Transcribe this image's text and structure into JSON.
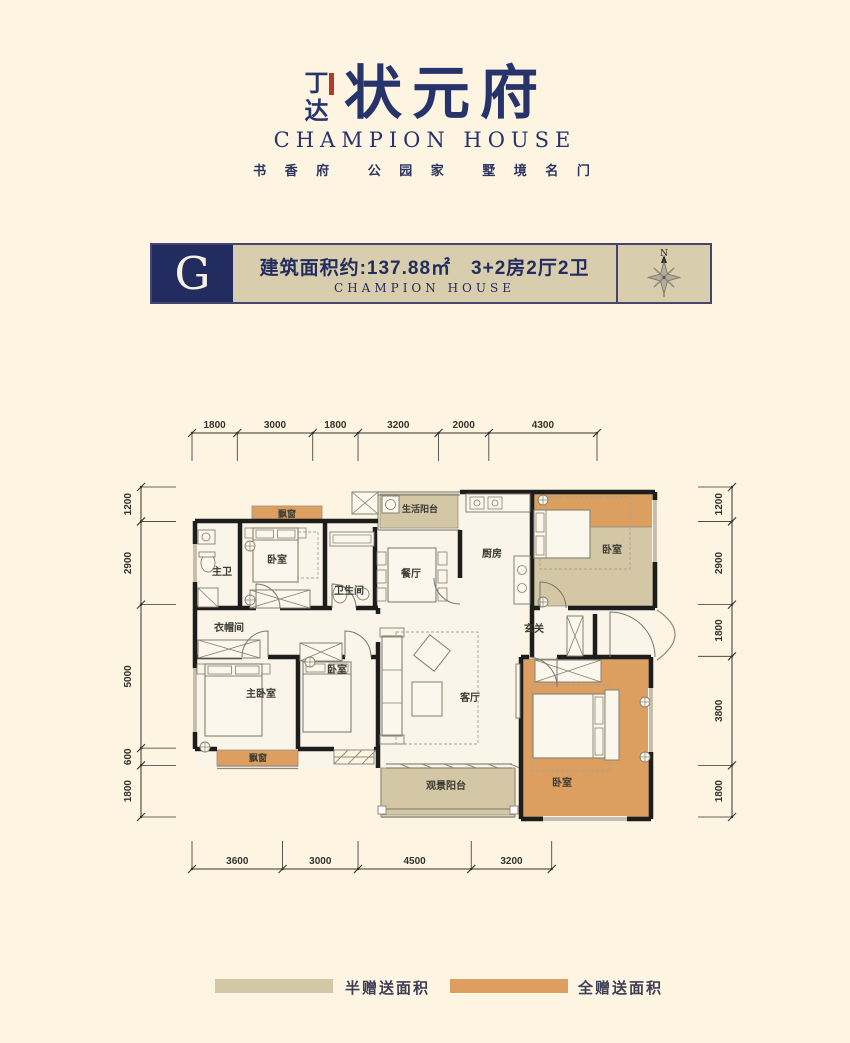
{
  "logo": {
    "brand_vertical": "丁达",
    "seal_color": "#b43a2a",
    "title": "状元府",
    "title_en": "CHAMPION HOUSE",
    "tagline": "书 香 府　 公 园 家　 墅 境 名 门",
    "color": "#27336b"
  },
  "banner": {
    "unit_letter": "G",
    "line1": "建筑面积约:137.88㎡　3+2房2厅2卫",
    "line2": "CHAMPION  HOUSE",
    "navy": "#232c5f",
    "beige": "#d8cdad",
    "border": "#45456d",
    "compass": {
      "label": "N"
    }
  },
  "floor_plan": {
    "wall_color": "#1d1d1d",
    "room_fill": "#faf5e8",
    "half_gift_color": "#d3c7a6",
    "full_gift_color": "#dc9f60",
    "dims": {
      "top": [
        1800,
        3000,
        1800,
        3200,
        2000,
        4300
      ],
      "bottom": [
        3600,
        3000,
        4500,
        3200
      ],
      "left": [
        1200,
        2900,
        5000,
        600,
        1800
      ],
      "right": [
        1200,
        2900,
        1800,
        3800,
        1800
      ]
    },
    "zones": [
      {
        "type": "full",
        "name": "bay-window-bedroom1",
        "x": 252,
        "y": 506,
        "w": 70,
        "h": 15
      },
      {
        "type": "full",
        "name": "bedroom2-upper",
        "x": 534,
        "y": 494,
        "w": 119,
        "h": 33
      },
      {
        "type": "half",
        "name": "bedroom2-lower",
        "x": 534,
        "y": 527,
        "w": 119,
        "h": 79
      },
      {
        "type": "half",
        "name": "life-balcony",
        "x": 380,
        "y": 494,
        "w": 78,
        "h": 34
      },
      {
        "type": "full",
        "name": "bay-window-master",
        "x": 217,
        "y": 750,
        "w": 81,
        "h": 16
      },
      {
        "type": "full",
        "name": "bedroom4",
        "x": 523,
        "y": 659,
        "w": 126,
        "h": 158
      },
      {
        "type": "half",
        "name": "view-balcony",
        "x": 381,
        "y": 768,
        "w": 134,
        "h": 47
      }
    ],
    "labels": [
      {
        "text": "主卫",
        "x": 222,
        "y": 575
      },
      {
        "text": "卧室",
        "x": 277,
        "y": 563
      },
      {
        "text": "卫生间",
        "x": 349,
        "y": 594
      },
      {
        "text": "餐厅",
        "x": 411,
        "y": 577
      },
      {
        "text": "生活阳台",
        "x": 420,
        "y": 512,
        "s": 9
      },
      {
        "text": "厨房",
        "x": 492,
        "y": 557
      },
      {
        "text": "卧室",
        "x": 612,
        "y": 553
      },
      {
        "text": "玄关",
        "x": 534,
        "y": 632
      },
      {
        "text": "衣帽间",
        "x": 229,
        "y": 631
      },
      {
        "text": "主卧室",
        "x": 261,
        "y": 697
      },
      {
        "text": "卧室",
        "x": 337,
        "y": 673
      },
      {
        "text": "客厅",
        "x": 470,
        "y": 701
      },
      {
        "text": "飘窗",
        "x": 287,
        "y": 517,
        "s": 9
      },
      {
        "text": "飘窗",
        "x": 258,
        "y": 761,
        "s": 9
      },
      {
        "text": "观景阳台",
        "x": 446,
        "y": 789
      },
      {
        "text": "卧室",
        "x": 562,
        "y": 786
      }
    ]
  },
  "legend": [
    {
      "label": "半赠送面积",
      "color": "#d3c7a6"
    },
    {
      "label": "全赠送面积",
      "color": "#dc9f60"
    }
  ]
}
